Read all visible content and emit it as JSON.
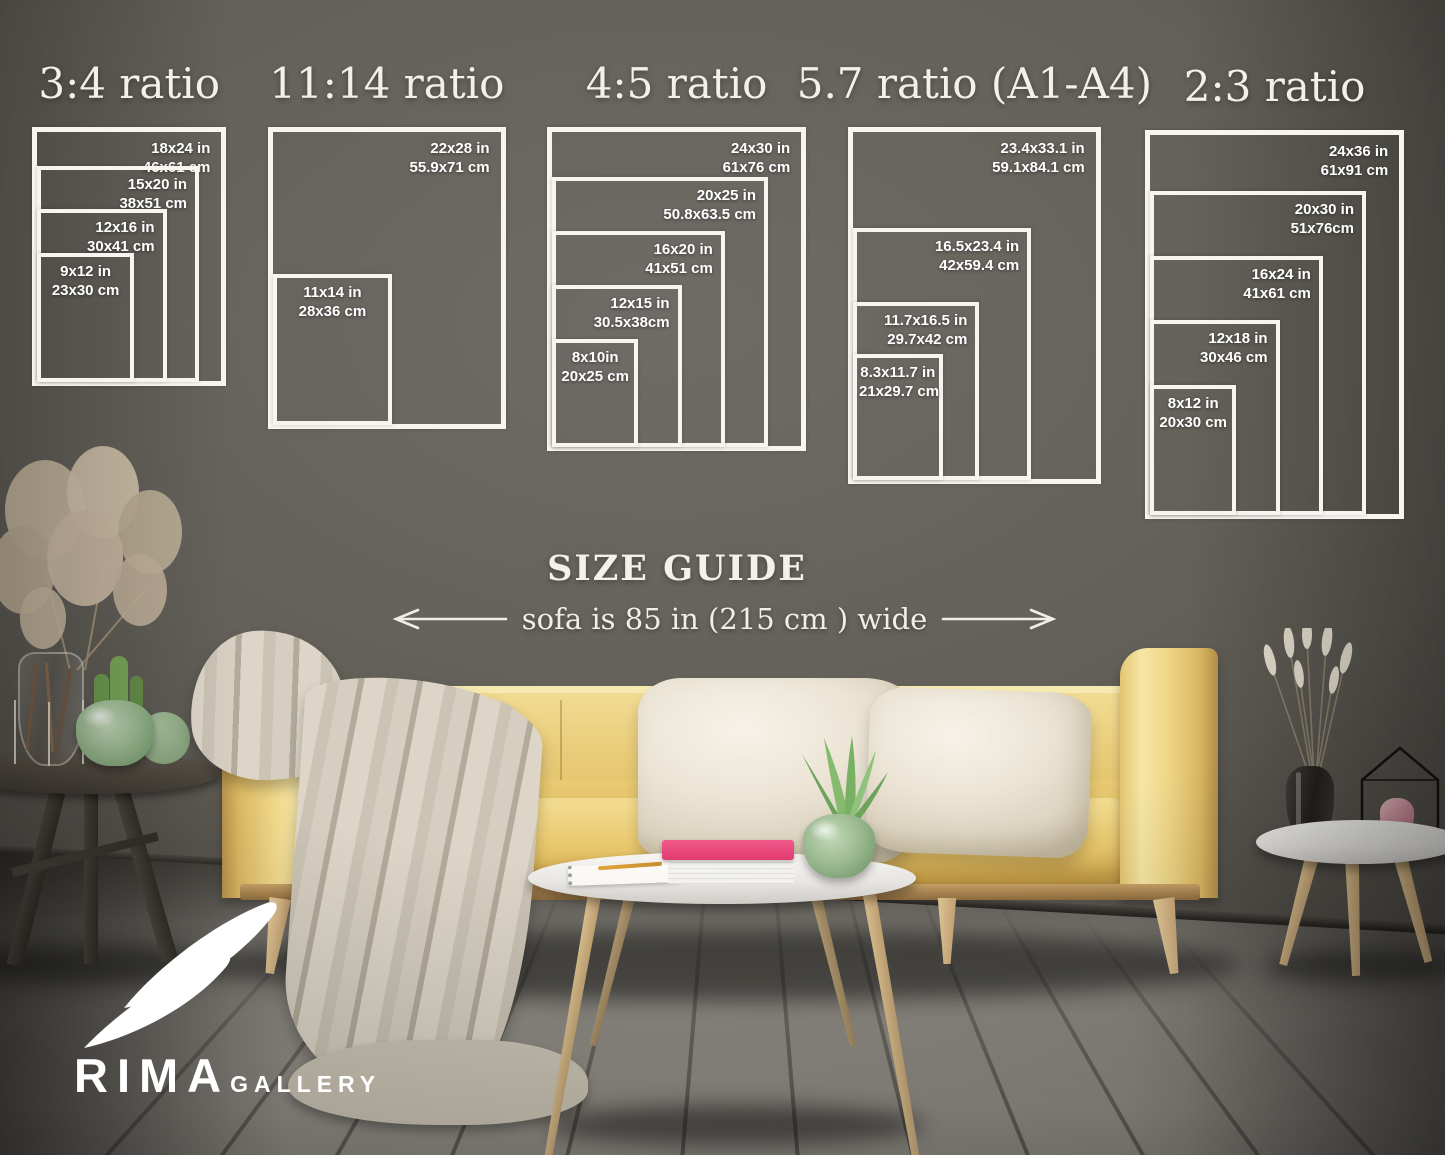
{
  "headings": {
    "size_guide": "SIZE GUIDE",
    "sofa_note": "sofa is 85 in (215 cm ) wide"
  },
  "logo": {
    "brand": "RIMA",
    "suffix": "GALLERY"
  },
  "palette": {
    "line_white": "#f7f5f0",
    "wall_center": "#6b6762",
    "wall_edge": "#332f2b",
    "floor_gray": "#8b8881",
    "sofa_yellow": "#e9cb74",
    "pillow_cream": "#ece5d6",
    "blanket_beige": "#d3ccbd",
    "book_pink": "#e84378",
    "vase_green": "#9dbb93",
    "wood_light": "#d9b98c"
  },
  "scale_px_per_inch": 10.8,
  "ratio_groups": [
    {
      "id": "3-4",
      "title": "3:4 ratio",
      "left": 32,
      "top": 127,
      "sizes": [
        {
          "w": 18,
          "h": 24,
          "inches": "18x24 in",
          "cm": "46x61 cm"
        },
        {
          "w": 15,
          "h": 20,
          "inches": "15x20 in",
          "cm": "38x51 cm"
        },
        {
          "w": 12,
          "h": 16,
          "inches": "12x16 in",
          "cm": "30x41 cm"
        },
        {
          "w": 9,
          "h": 12,
          "inches": "9x12 in",
          "cm": "23x30 cm"
        }
      ]
    },
    {
      "id": "11-14",
      "title": "11:14 ratio",
      "left": 268,
      "top": 127,
      "sizes": [
        {
          "w": 22,
          "h": 28,
          "inches": "22x28 in",
          "cm": "55.9x71 cm"
        },
        {
          "w": 11,
          "h": 14,
          "inches": "11x14 in",
          "cm": "28x36 cm"
        }
      ]
    },
    {
      "id": "4-5",
      "title": "4:5 ratio",
      "left": 547,
      "top": 127,
      "sizes": [
        {
          "w": 24,
          "h": 30,
          "inches": "24x30 in",
          "cm": "61x76 cm"
        },
        {
          "w": 20,
          "h": 25,
          "inches": "20x25 in",
          "cm": "50.8x63.5 cm"
        },
        {
          "w": 16,
          "h": 20,
          "inches": "16x20 in",
          "cm": "41x51 cm"
        },
        {
          "w": 12,
          "h": 15,
          "inches": "12x15 in",
          "cm": "30.5x38cm"
        },
        {
          "w": 8,
          "h": 10,
          "inches": "8x10in",
          "cm": "20x25 cm"
        }
      ]
    },
    {
      "id": "5-7",
      "title": "5.7 ratio (A1-A4)",
      "left": 848,
      "top": 127,
      "sizes": [
        {
          "w": 23.4,
          "h": 33.1,
          "inches": "23.4x33.1 in",
          "cm": "59.1x84.1 cm"
        },
        {
          "w": 16.5,
          "h": 23.4,
          "inches": "16.5x23.4 in",
          "cm": "42x59.4 cm"
        },
        {
          "w": 11.7,
          "h": 16.5,
          "inches": "11.7x16.5 in",
          "cm": "29.7x42 cm"
        },
        {
          "w": 8.3,
          "h": 11.7,
          "inches": "8.3x11.7 in",
          "cm": "21x29.7 cm"
        }
      ]
    },
    {
      "id": "2-3",
      "title": "2:3 ratio",
      "left": 1145,
      "top": 130,
      "sizes": [
        {
          "w": 24,
          "h": 36,
          "inches": "24x36 in",
          "cm": "61x91 cm"
        },
        {
          "w": 20,
          "h": 30,
          "inches": "20x30 in",
          "cm": "51x76cm"
        },
        {
          "w": 16,
          "h": 24,
          "inches": "16x24 in",
          "cm": "41x61 cm"
        },
        {
          "w": 12,
          "h": 18,
          "inches": "12x18 in",
          "cm": "30x46 cm"
        },
        {
          "w": 8,
          "h": 12,
          "inches": "8x12 in",
          "cm": "20x30 cm"
        }
      ]
    }
  ]
}
